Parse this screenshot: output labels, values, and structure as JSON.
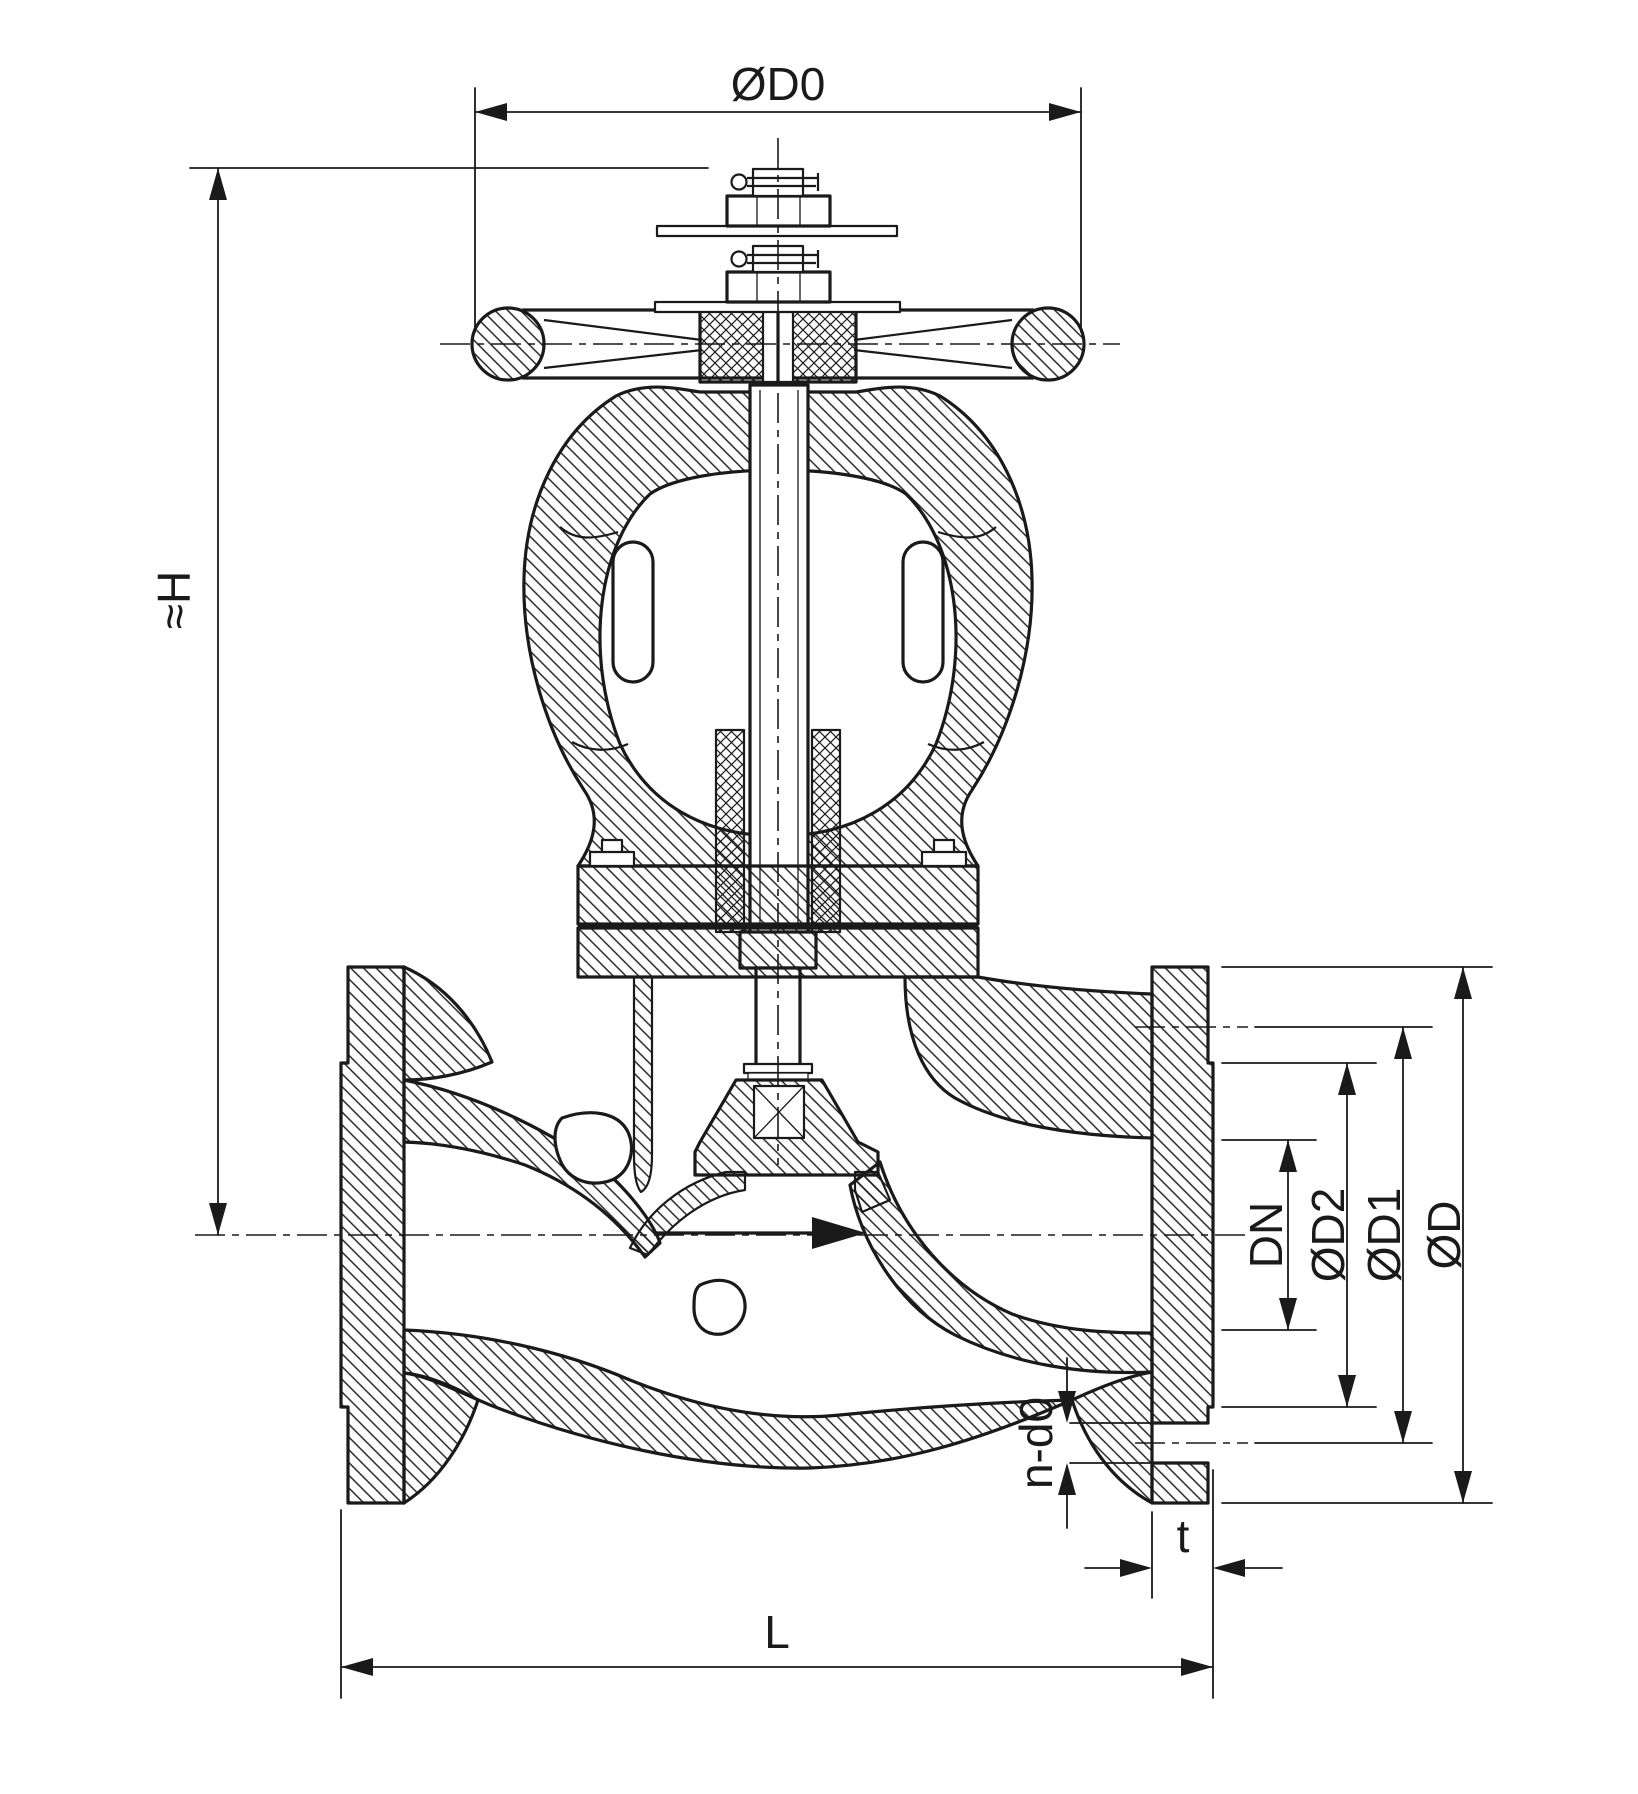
{
  "drawing": {
    "title": "Flanged globe valve sectional drawing",
    "background_color": "#ffffff",
    "line_color": "#1a1a1a",
    "view": "front section",
    "dimensions": {
      "handwheel_diameter": "ØD0",
      "height_approx": "≈H",
      "nominal_bore": "DN",
      "raised_face_diameter": "ØD2",
      "bolt_circle_diameter": "ØD1",
      "flange_outer_diameter": "ØD",
      "bolt_holes": "n-d0",
      "flange_thickness": "t",
      "face_to_face": "L"
    }
  }
}
